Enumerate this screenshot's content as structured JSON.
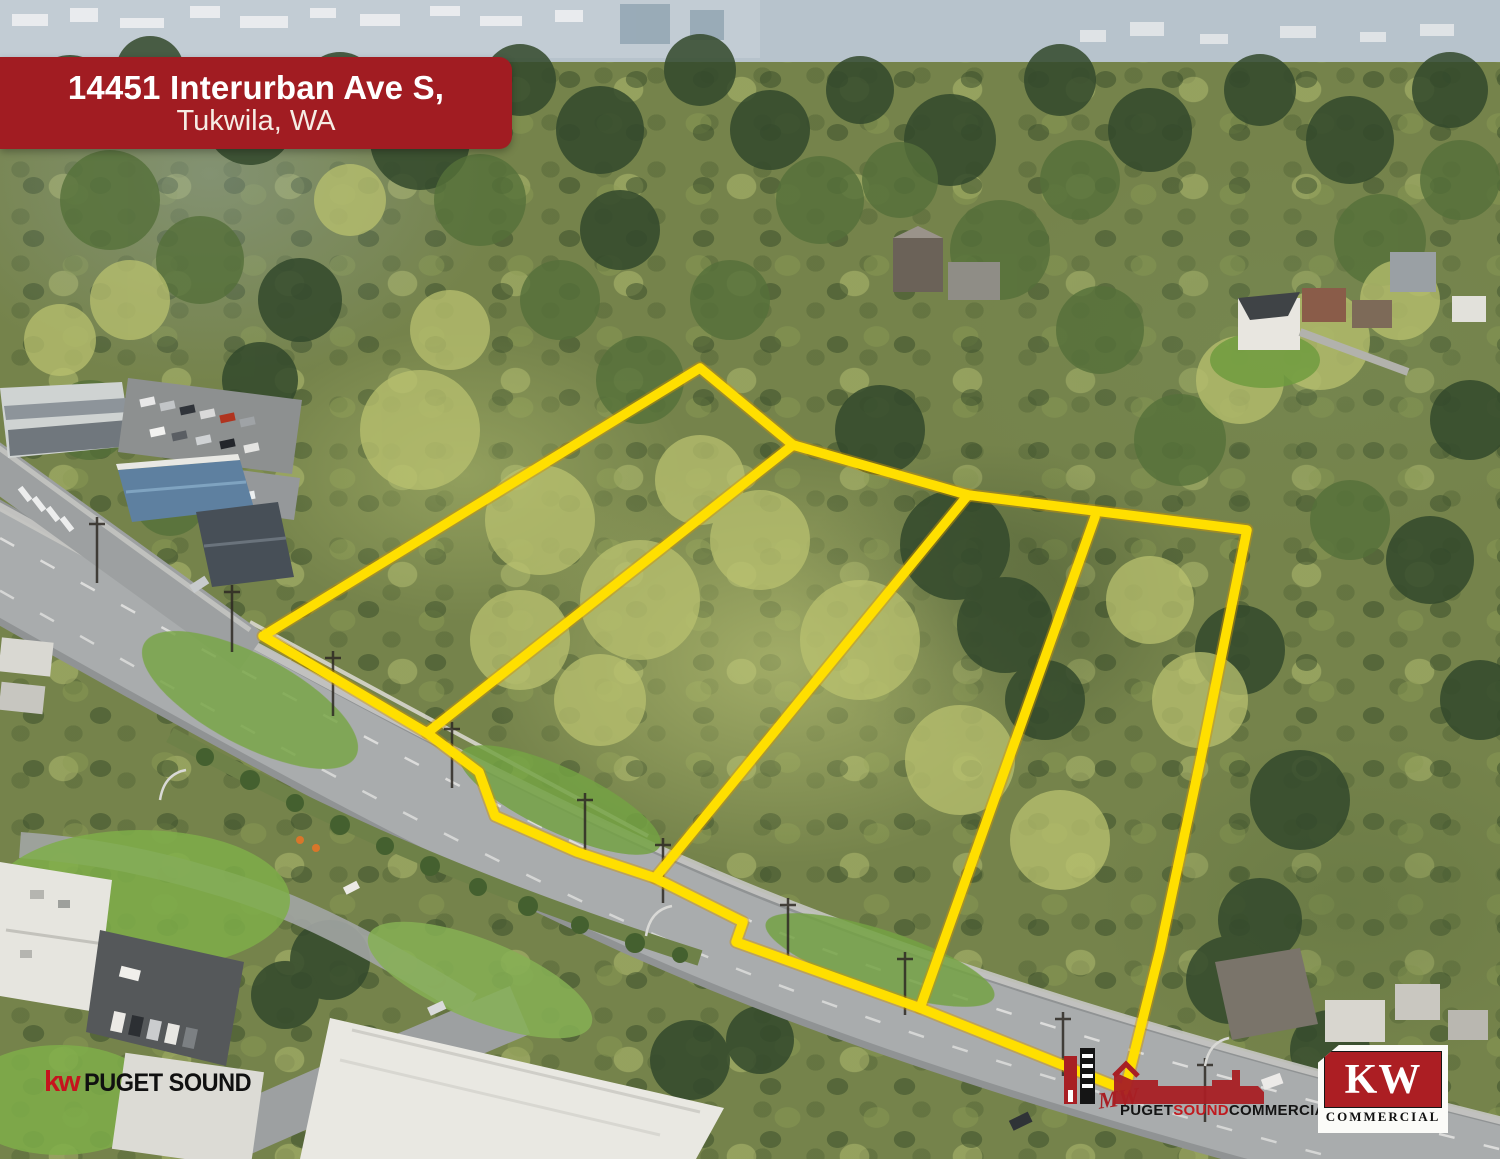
{
  "banner": {
    "line1": "14451 Interurban Ave S,",
    "line2": "Tukwila, WA",
    "bg_color": "#a11c22"
  },
  "overlay": {
    "color": "#ffdf00",
    "outer": "263,636 700,368 793,445 968,495 1247,530 1200,762 1160,950 1125,1090 920,1008 736,942 743,922 655,878 577,852 495,816 479,772 427,733 263,636",
    "dividers": [
      "793,445 427,733",
      "968,495 655,878",
      "1095,517 920,1008"
    ]
  },
  "logos": {
    "kw_puget_sound": {
      "kw": "kw",
      "name": "PUGET SOUND",
      "kw_color": "#c6131d"
    },
    "puget_sound_commercial": {
      "script": "MW",
      "word_puget": "PUGET",
      "word_sound": "SOUND",
      "word_commercial": "COMMERCIAL",
      "red": "#a81f24"
    },
    "kw_commercial": {
      "kw": "KW",
      "word": "COMMERCIAL",
      "red": "#ac1e23"
    }
  }
}
